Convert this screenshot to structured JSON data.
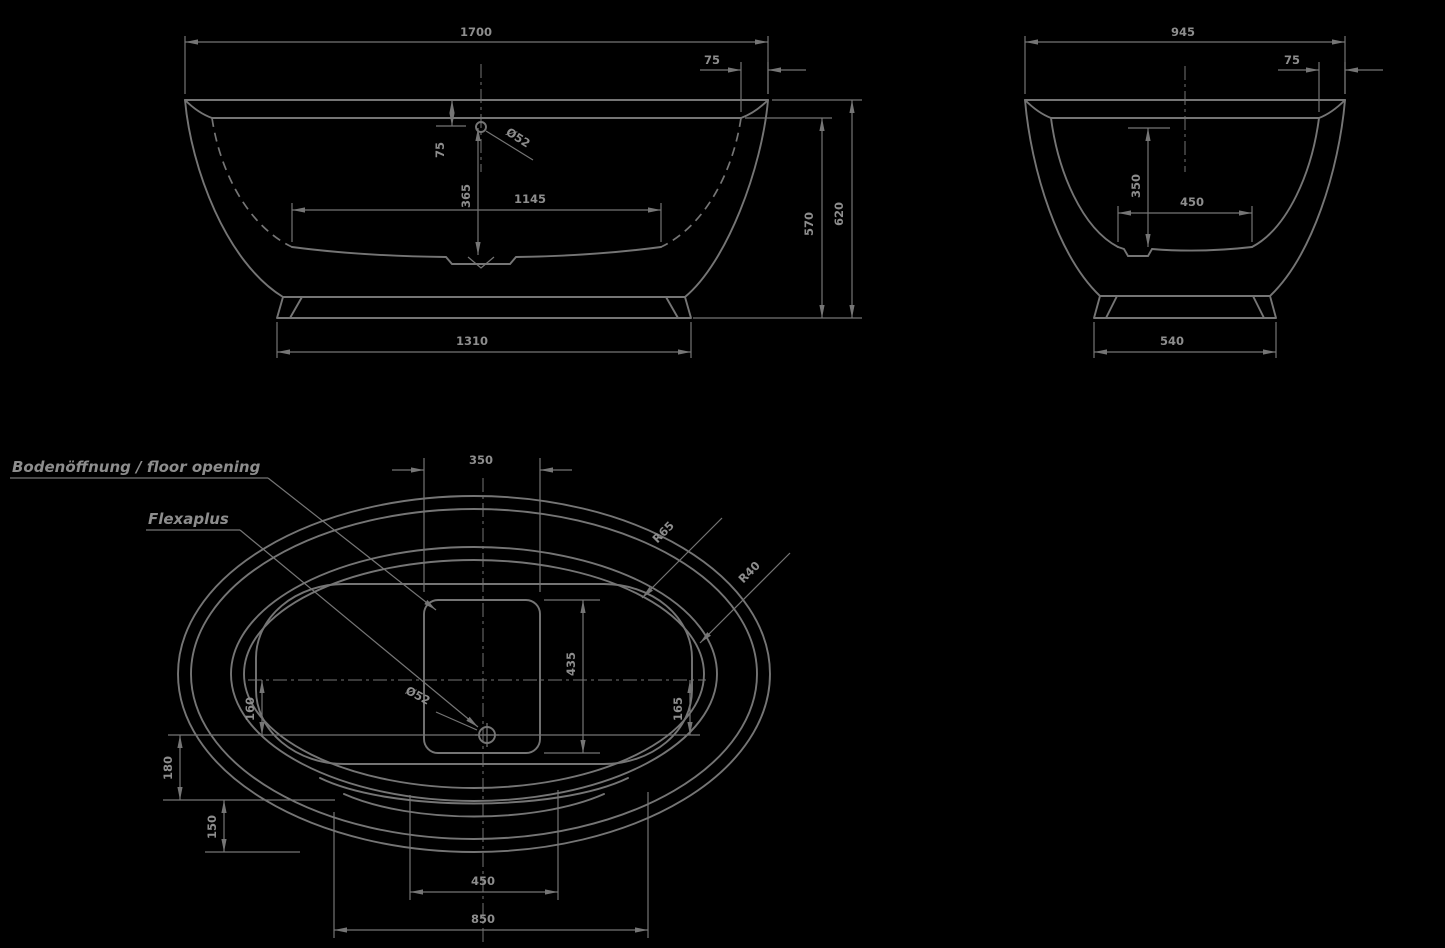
{
  "colors": {
    "background": "#000000",
    "line": "#757575",
    "text": "#8d8d8d"
  },
  "drawing": {
    "title": "bathtub-technical-drawing",
    "front_view": {
      "overall_length": "1700",
      "rim_width": "75",
      "rim_to_waterline": "75",
      "waterline_to_bottom": "365",
      "drain_diameter": "Ø52",
      "inner_bottom_length": "1145",
      "base_length": "1310",
      "inner_height": "570",
      "overall_height": "620"
    },
    "end_view": {
      "overall_width": "945",
      "rim_width": "75",
      "water_depth": "350",
      "inner_bottom_width": "450",
      "base_width": "540"
    },
    "plan_view": {
      "floor_opening_label": "Bodenöffnung / floor opening",
      "waste_label": "Flexaplus",
      "floor_opening_width": "350",
      "floor_opening_length": "435",
      "rim_radius_outer": "R65",
      "rim_radius_inner": "R40",
      "drain_diameter": "Ø52",
      "drain_offset_left": "160",
      "drain_offset_right": "165",
      "edge_offset_a": "180",
      "edge_offset_b": "150",
      "drain_span": "450",
      "overall_span": "850"
    }
  }
}
